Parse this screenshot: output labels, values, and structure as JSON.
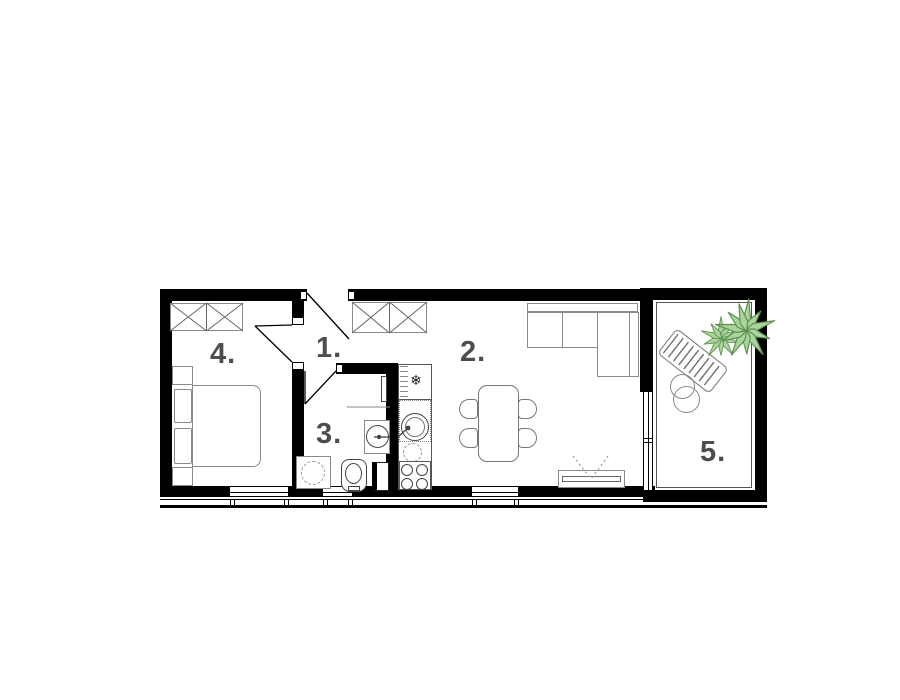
{
  "floorplan": {
    "rooms": [
      {
        "id": "hall",
        "label": "1.",
        "items": [
          "entry-door",
          "wardrobe"
        ]
      },
      {
        "id": "living-kitchen",
        "label": "2.",
        "items": [
          "corner-sofa",
          "dining-table",
          "four-chairs",
          "tv-stand",
          "fridge",
          "kitchen-sink",
          "stove",
          "terrace-glazing"
        ]
      },
      {
        "id": "bathroom",
        "label": "3.",
        "items": [
          "washing-machine",
          "toilet",
          "sink",
          "radiator",
          "window"
        ]
      },
      {
        "id": "bedroom",
        "label": "4.",
        "items": [
          "wardrobe",
          "double-bed",
          "pillows",
          "nightstands",
          "window"
        ]
      },
      {
        "id": "terrace",
        "label": "5.",
        "items": [
          "sun-lounger",
          "side-tables",
          "plant"
        ]
      }
    ],
    "icons": {
      "fridge_snowflake": "❄"
    },
    "colors": {
      "wall": "#000000",
      "furniture_line": "#8a8a8a",
      "fixture_line": "#444444",
      "label_text": "#4d4d4d",
      "plant_fill": "#abd49c",
      "plant_stroke": "#5d9150",
      "background": "#ffffff"
    }
  }
}
